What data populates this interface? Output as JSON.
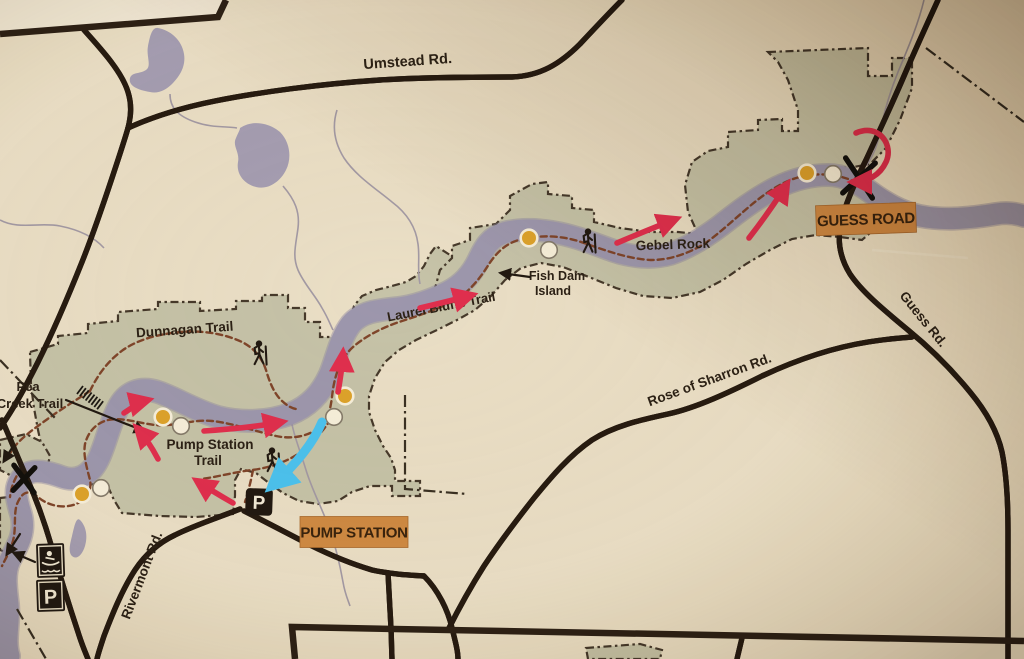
{
  "map": {
    "title": "trail-map",
    "roads": {
      "umstead": "Umstead Rd.",
      "guess": "Guess Rd.",
      "rose_of_sharron": "Rose of Sharron Rd.",
      "rivermont": "Rivermont Rd."
    },
    "trails": {
      "pea_creek_line1": "Pea",
      "pea_creek_line2": "Creek Trail",
      "dunnagan": "Dunnagan Trail",
      "pump_station_line1": "Pump Station",
      "pump_station_line2": "Trail",
      "laurel_bluffs": "Laurel Bluffs Trail"
    },
    "places": {
      "gebel_rock": "Gebel Rock",
      "fish_dam_line1": "Fish Dam",
      "fish_dam_line2": "Island"
    },
    "badges": {
      "guess_road": "GUESS ROAD",
      "pump_station": "PUMP STATION"
    },
    "icons": {
      "parking_label": "P",
      "parking": "parking-icon",
      "canoe_access": "canoe-access-icon",
      "hiker": "hiker-icon",
      "river_crossing": "crossing-x-icon"
    },
    "colors": {
      "paper": "#eadfc7",
      "paper_light": "#f1e9d8",
      "park_green": "#c6c3a9",
      "river_purple": "#9d97ae",
      "road_dark": "#271b10",
      "trail_brown": "#7f452a",
      "boundary_dark": "#46392a",
      "red_arrow": "#e02f4e",
      "blue_arrow": "#4cc2f0",
      "badge_orange": "#cf8a43",
      "dot_yellow": "#dda32b",
      "dot_white": "#f6efdc",
      "label_ink": "#2c2115",
      "icon_black": "#221911"
    }
  }
}
